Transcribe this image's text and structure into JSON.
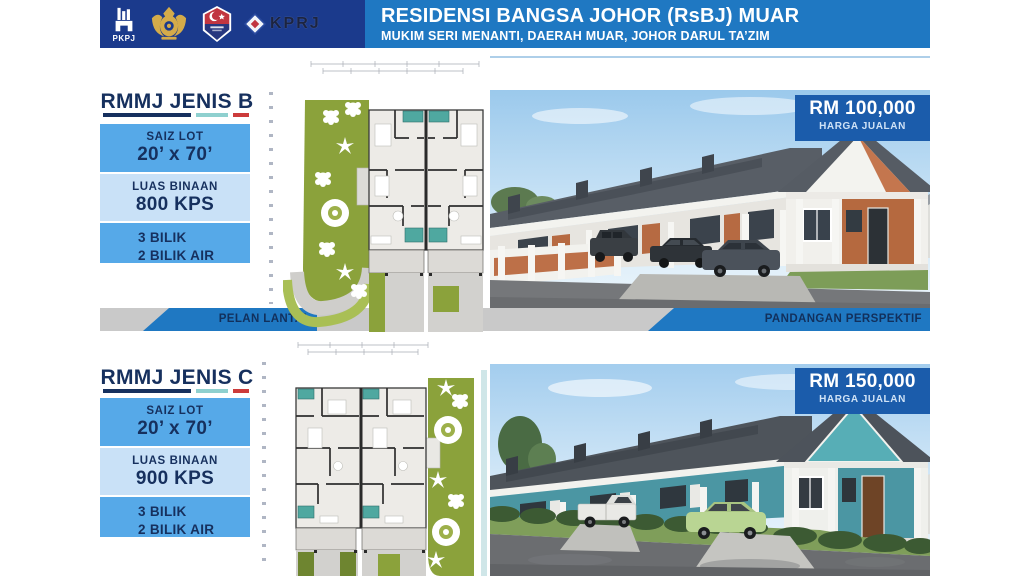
{
  "header": {
    "title": "RESIDENSI BANGSA JOHOR (RsBJ) MUAR",
    "subtitle": "MUKIM SERI MENANTI, DAERAH MUAR, JOHOR DARUL TA’ZIM",
    "logos": [
      {
        "name": "pkpj",
        "label": "PKPJ"
      },
      {
        "name": "johor-royal-crest",
        "label": ""
      },
      {
        "name": "johor-crescent-shield",
        "label": ""
      },
      {
        "name": "kprj",
        "label": "KPRJ"
      }
    ]
  },
  "sections": [
    {
      "title": "RMMJ JENIS B",
      "specs": [
        {
          "label": "SAIZ LOT",
          "value": "20’ x 70’"
        },
        {
          "label": "LUAS BINAAN",
          "value": "800 KPS"
        },
        {
          "label": "3 BILIK",
          "value": "2 BILIK AIR"
        }
      ],
      "price": "RM 100,000",
      "price_label": "HARGA JUALAN",
      "captions": {
        "plan": "PELAN LANTAI",
        "perspective": "PANDANGAN PERSPEKTIF"
      }
    },
    {
      "title": "RMMJ JENIS C",
      "specs": [
        {
          "label": "SAIZ LOT",
          "value": "20’ x 70’"
        },
        {
          "label": "LUAS BINAAN",
          "value": "900 KPS"
        },
        {
          "label": "3 BILIK",
          "value": "2 BILIK AIR"
        }
      ],
      "price": "RM 150,000",
      "price_label": "HARGA JUALAN"
    }
  ],
  "colors": {
    "header_navy": "#1b3a8c",
    "header_blue": "#1f78c2",
    "box_blue": "#56a9e8",
    "box_light_blue": "#c9e1f7",
    "text_navy": "#16305e",
    "badge_blue": "#1b5cab",
    "band_gray": "#c9c9c9",
    "underline_teal": "#8fd0cf",
    "underline_red": "#cc3b3b"
  }
}
